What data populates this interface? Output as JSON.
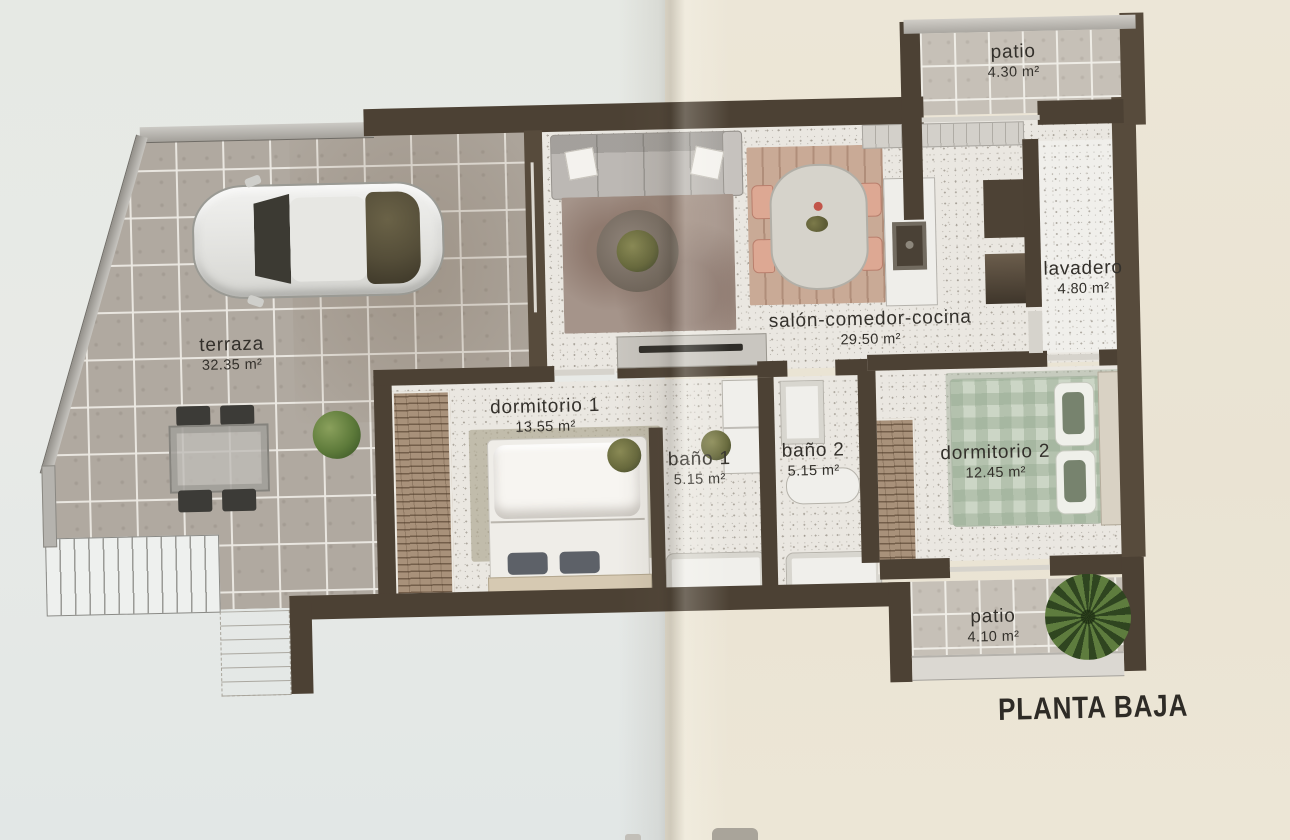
{
  "title": "PLANTA BAJA",
  "rooms": {
    "terraza": {
      "name": "terraza",
      "area": "32.35 m²"
    },
    "salon_comedor_cocina": {
      "name": "salón-comedor-cocina",
      "area": "29.50 m²"
    },
    "lavadero": {
      "name": "lavadero",
      "area": "4.80 m²"
    },
    "patio_superior": {
      "name": "patio",
      "area": "4.30 m²"
    },
    "dormitorio_1": {
      "name": "dormitorio 1",
      "area": "13.55 m²"
    },
    "bano_1": {
      "name": "baño 1",
      "area": "5.15 m²"
    },
    "bano_2": {
      "name": "baño 2",
      "area": "5.15 m²"
    },
    "dormitorio_2": {
      "name": "dormitorio 2",
      "area": "12.45 m²"
    },
    "patio_inferior": {
      "name": "patio",
      "area": "4.10 m²"
    }
  },
  "colors": {
    "wall": "#4c4134",
    "terraza_tile": "#b0a9a0",
    "patio_tile": "#c6c0b7",
    "interior_floor": "#eae7e1",
    "paper_left": "#e8eae6",
    "paper_right": "#ebe5d5",
    "label_text": "#33302b"
  }
}
